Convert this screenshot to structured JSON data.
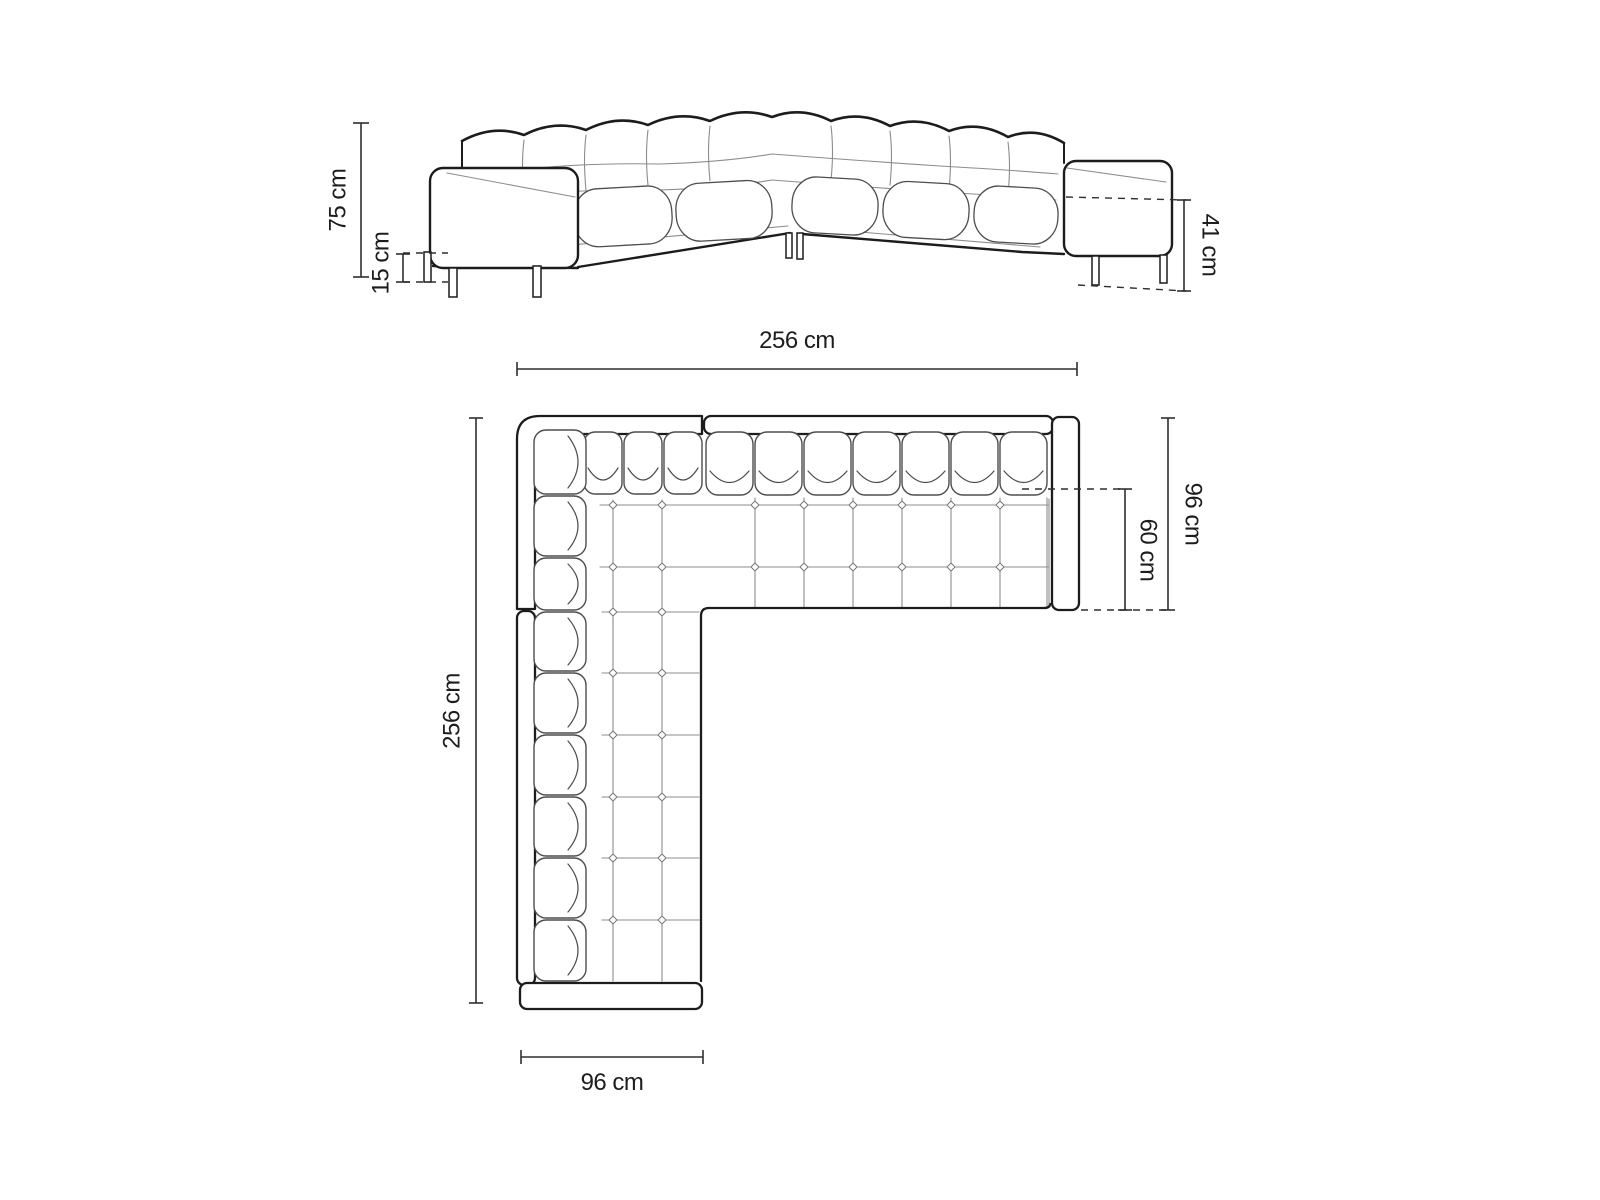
{
  "style": {
    "background": "#ffffff",
    "line_color": "#1c1c1c",
    "thin_line_color": "#8c8c8c",
    "cushion_line_color": "#4d4d4d",
    "dim_line_color": "#2f2f2f"
  },
  "views": {
    "front_elevation": {
      "dimensions": {
        "total_height": "75 cm",
        "leg_height": "15 cm",
        "arm_seat_height": "41 cm"
      }
    },
    "top_plan": {
      "dimensions": {
        "total_width": "256 cm",
        "total_length": "256 cm",
        "side_depth": "96 cm",
        "seat_depth": "60 cm",
        "chaise_width": "96 cm"
      }
    }
  }
}
